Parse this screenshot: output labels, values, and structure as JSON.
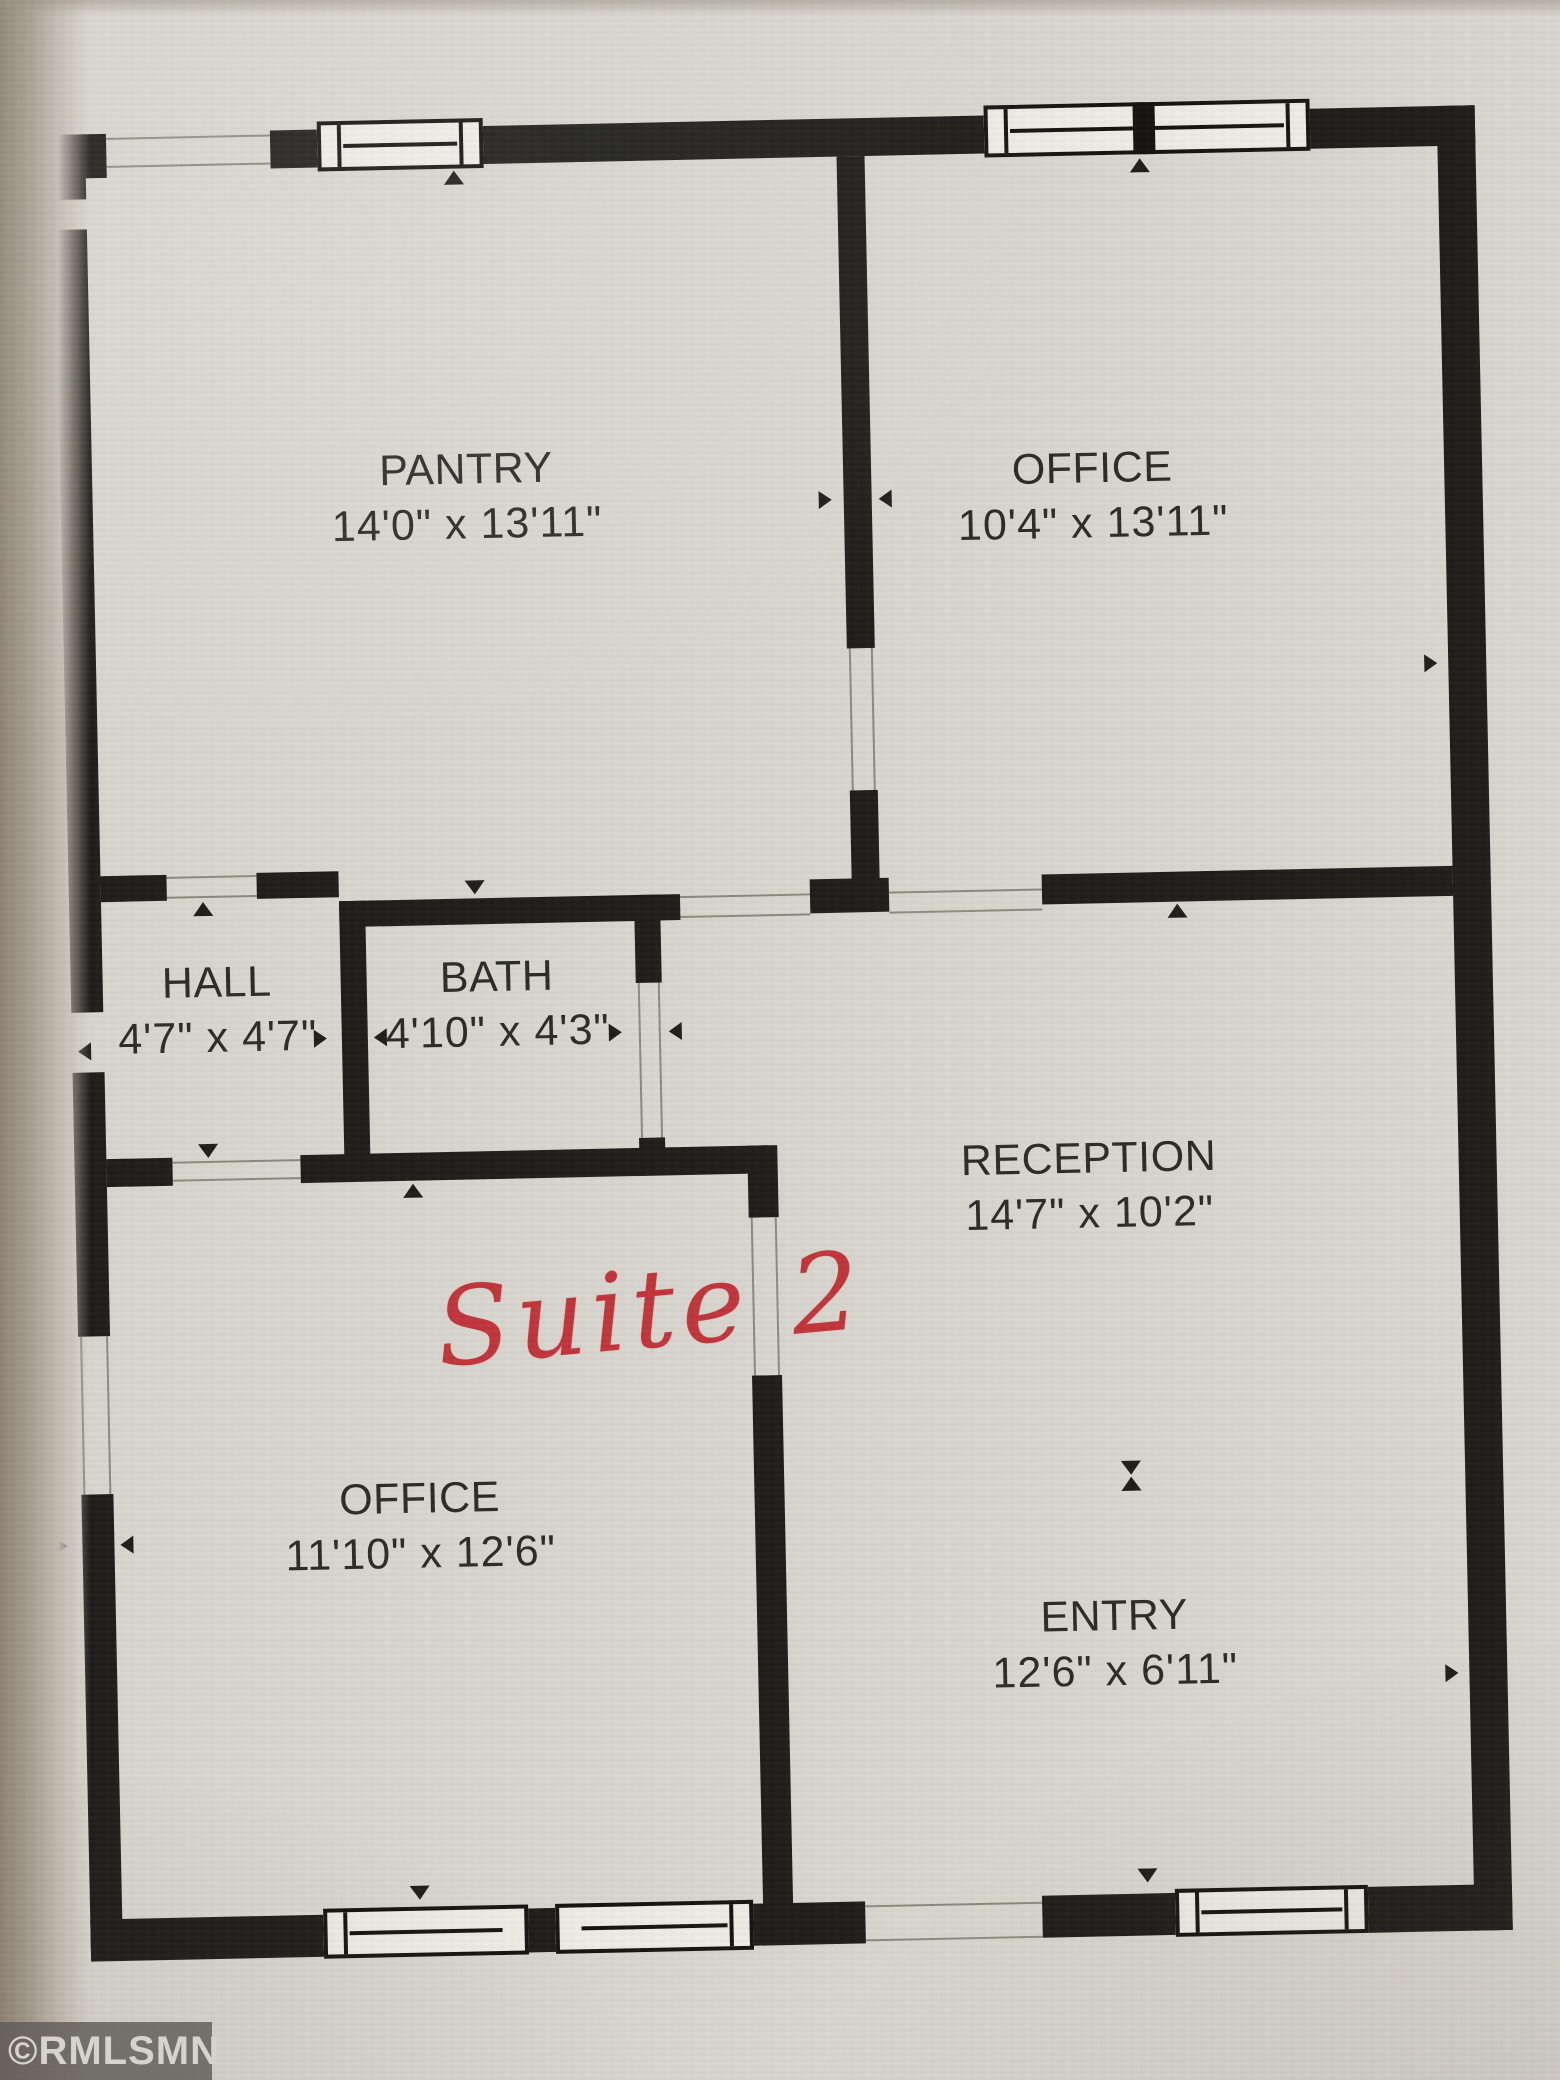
{
  "document": {
    "kind": "floor plan",
    "watermark": "©RMLSMN",
    "annotation": "Suite 2"
  },
  "rooms": [
    {
      "id": "pantry",
      "name": "PANTRY",
      "dims": "14'0\" x 13'11\""
    },
    {
      "id": "office-top",
      "name": "OFFICE",
      "dims": "10'4\" x 13'11\""
    },
    {
      "id": "hall",
      "name": "HALL",
      "dims": "4'7\" x 4'7\""
    },
    {
      "id": "bath",
      "name": "BATH",
      "dims": "4'10\" x 4'3\""
    },
    {
      "id": "reception",
      "name": "RECEPTION",
      "dims": "14'7\" x 10'2\""
    },
    {
      "id": "office-lower",
      "name": "OFFICE",
      "dims": "11'10\" x 12'6\""
    },
    {
      "id": "entry",
      "name": "ENTRY",
      "dims": "12'6\" x 6'11\""
    }
  ],
  "colors": {
    "wall": "#1e1d1a",
    "page": "#d8d5ce",
    "ink": "#2b2a27",
    "handwriting_red": "#c0343a",
    "watermark_bg": "#5f5c56",
    "watermark_text": "#d6d3cc"
  }
}
